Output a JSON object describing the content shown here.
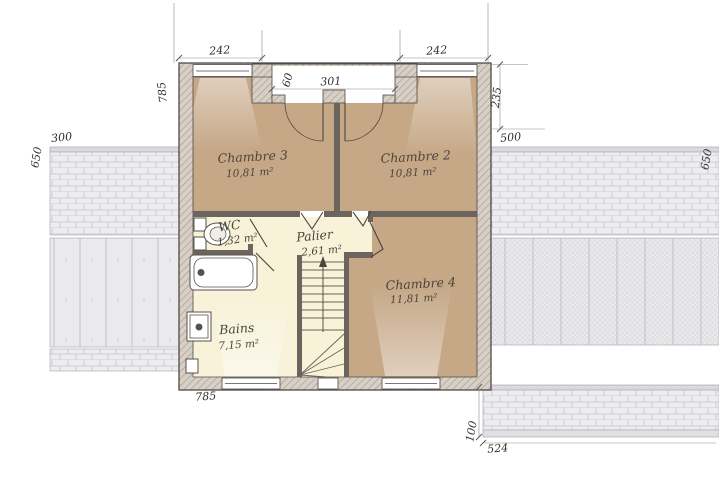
{
  "plan": {
    "title": "Etage floor plan",
    "rooms": [
      {
        "name": "Chambre 3",
        "area": "10,81 m²"
      },
      {
        "name": "Chambre 2",
        "area": "10,81 m²"
      },
      {
        "name": "Chambre 4",
        "area": "11,81 m²"
      },
      {
        "name": "Palier",
        "area": "2,61 m²"
      },
      {
        "name": "WC",
        "area": "1,32 m²"
      },
      {
        "name": "Bains",
        "area": "7,15 m²"
      }
    ],
    "dims": {
      "window_left": "242",
      "window_right": "242",
      "niche_width": "301",
      "niche_depth": "60",
      "left_wall": "785",
      "right_wall_top": "235",
      "left_offset": "300",
      "roof_left": "650",
      "right_offset": "500",
      "roof_right": "650",
      "bottom_wall": "785",
      "terrace_height": "100",
      "terrace_width": "524"
    },
    "colors": {
      "chambre_floor": "#c6a887",
      "service_floor": "#f8f2d9",
      "wall": "#d8d0c7",
      "roof": "#ededf0"
    }
  }
}
